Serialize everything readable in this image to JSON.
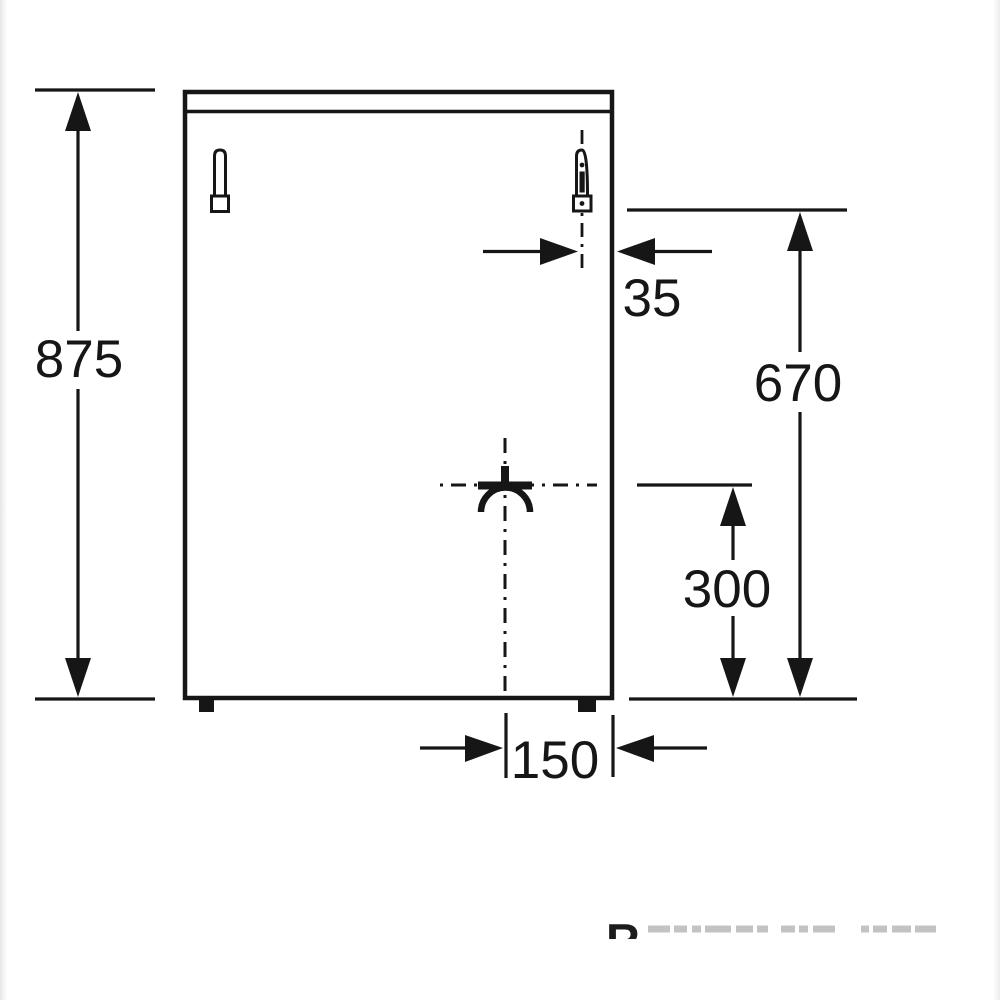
{
  "diagram": {
    "type": "appliance-rear-dimension-drawing",
    "dimension_labels": {
      "overall_height": "875",
      "upper_connection_height": "670",
      "lower_connection_height": "300",
      "side_offset": "35",
      "bottom_center_offset": "150"
    },
    "watermark": {
      "visible_letter": "R"
    },
    "colors": {
      "ink": "#161616",
      "background": "#ffffff",
      "watermark_faint": "#c3c3c3"
    }
  }
}
